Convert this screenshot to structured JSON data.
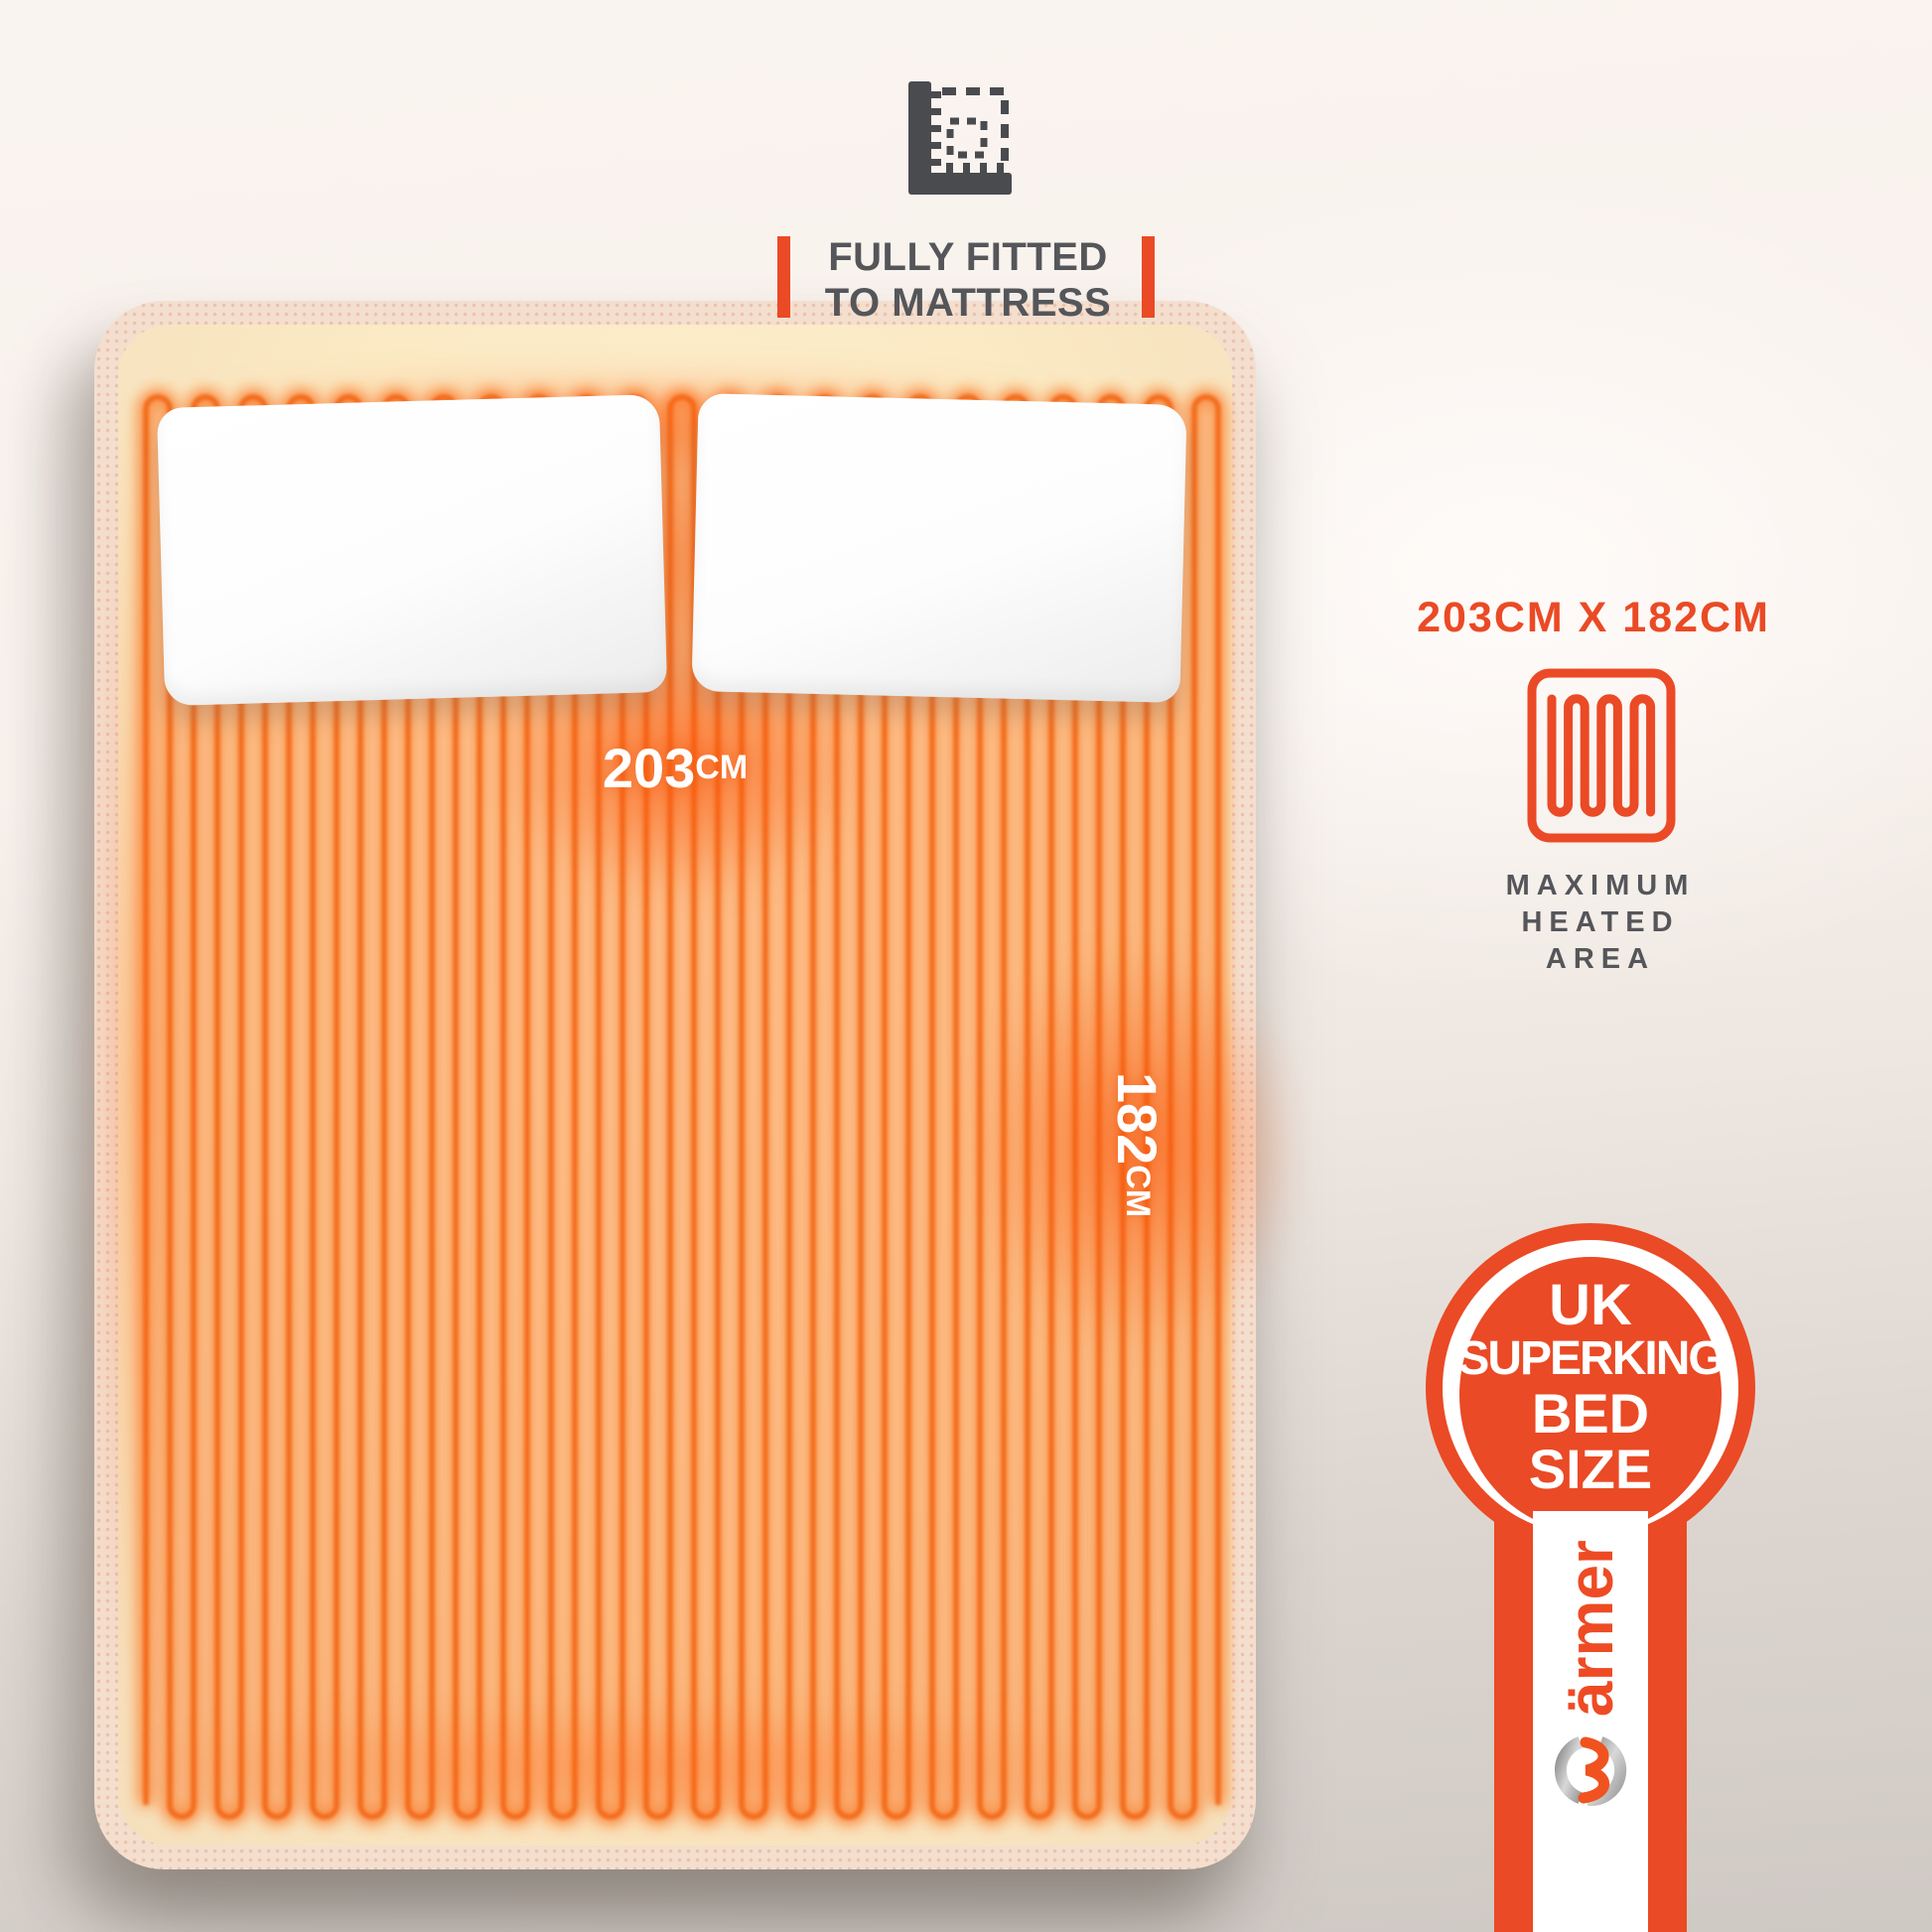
{
  "colors": {
    "accent": "#EA4A25",
    "wire_glow": "#F97222",
    "wire_core": "#F2610C",
    "bed_sheet": "#FCEBC6",
    "mattress_edge": "#F4DFCF",
    "text_gray": "#55565A",
    "background_top": "#FAF4F0",
    "background_bottom": "#CFC9C4"
  },
  "fitted_note": {
    "icon": "corner-ruler-icon",
    "line1": "FULLY FITTED",
    "line2": "TO MATTRESS"
  },
  "heated_area_panel": {
    "dimensions": "203CM X 182CM",
    "icon": "heating-element-icon",
    "lines": [
      "MAXIMUM",
      "HEATED",
      "AREA"
    ]
  },
  "bed": {
    "width_value": "203",
    "width_unit": "CM",
    "length_value": "182",
    "length_unit": "CM"
  },
  "size_badge": {
    "lines": [
      "UK",
      "SUPERKING",
      "BED",
      "SIZE"
    ]
  },
  "brand": {
    "name_text": "ärmer",
    "logo": "warmer-w-logo"
  }
}
